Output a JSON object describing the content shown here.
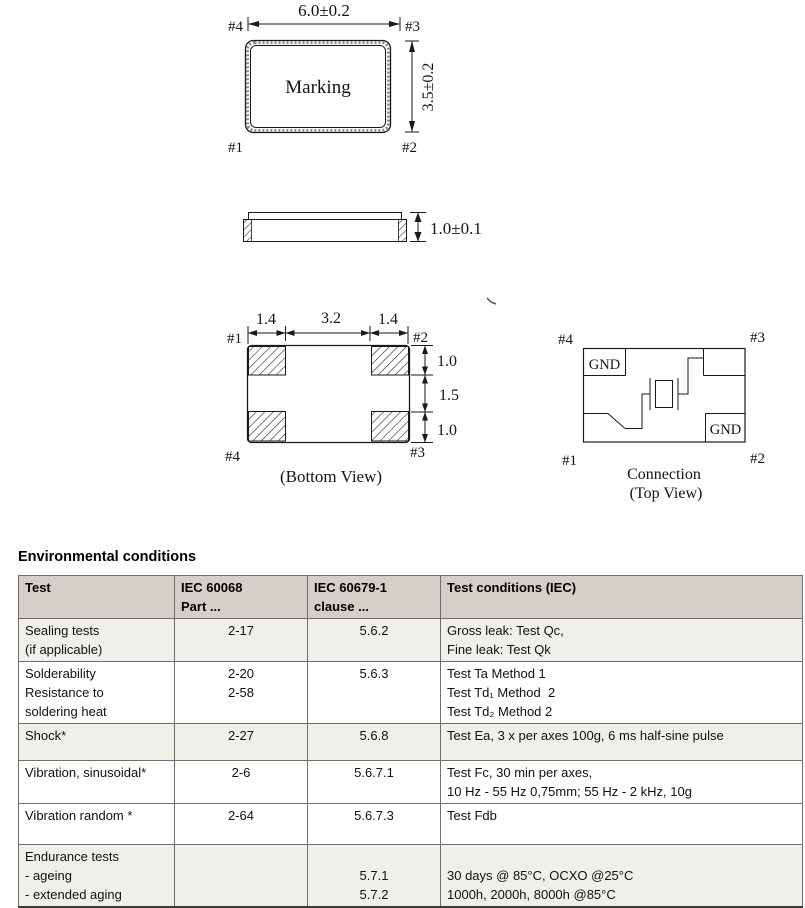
{
  "drawings": {
    "top_view": {
      "width_dim": "6.0±0.2",
      "height_dim": "3.5±0.2",
      "marking_label": "Marking",
      "pin_top_left": "#4",
      "pin_top_right": "#3",
      "pin_bottom_left": "#1",
      "pin_bottom_right": "#2"
    },
    "side_view": {
      "height_dim": "1.0±0.1"
    },
    "bottom_view": {
      "caption": "(Bottom View)",
      "dim_left": "1.4",
      "dim_center": "3.2",
      "dim_right": "1.4",
      "dim_top": "1.0",
      "dim_middle": "1.5",
      "dim_bottom": "1.0",
      "pin_top_left": "#1",
      "pin_top_right": "#2",
      "pin_bottom_left": "#4",
      "pin_bottom_right": "#3"
    },
    "connection_view": {
      "caption_line1": "Connection",
      "caption_line2": "(Top View)",
      "gnd_top_left": "GND",
      "gnd_bottom_right": "GND",
      "pin_top_left": "#4",
      "pin_top_right": "#3",
      "pin_bottom_left": "#1",
      "pin_bottom_right": "#2"
    }
  },
  "table": {
    "title": "Environmental conditions",
    "columns": [
      [
        "Test"
      ],
      [
        "IEC 60068",
        "Part ..."
      ],
      [
        "IEC 60679-1",
        "clause ..."
      ],
      [
        "Test conditions (IEC)"
      ]
    ],
    "rows": [
      {
        "test": [
          "Sealing tests",
          "(if applicable)"
        ],
        "part": [
          "2-17"
        ],
        "clause": [
          "5.6.2"
        ],
        "conditions": [
          "Gross leak: Test Qc,",
          "Fine leak: Test Qk"
        ]
      },
      {
        "test": [
          "Solderability",
          "Resistance to",
          "soldering heat"
        ],
        "part": [
          "2-20",
          "2-58"
        ],
        "clause": [
          "5.6.3"
        ],
        "conditions": [
          "Test Ta Method 1",
          "Test Td₁ Method  2",
          "Test Td₂ Method 2"
        ]
      },
      {
        "test": [
          "Shock*"
        ],
        "part": [
          "2-27"
        ],
        "clause": [
          "5.6.8"
        ],
        "conditions": [
          "Test Ea, 3 x per axes 100g, 6 ms half-sine pulse"
        ]
      },
      {
        "test": [
          "Vibration, sinusoidal*"
        ],
        "part": [
          "2-6"
        ],
        "clause": [
          "5.6.7.1"
        ],
        "conditions": [
          "Test Fc, 30 min per axes,",
          "10 Hz - 55 Hz 0,75mm; 55 Hz - 2 kHz, 10g"
        ]
      },
      {
        "test": [
          "Vibration random *"
        ],
        "part": [
          "2-64"
        ],
        "clause": [
          "5.6.7.3"
        ],
        "conditions": [
          "Test Fdb"
        ]
      },
      {
        "test": [
          "Endurance tests",
          "- ageing",
          "- extended aging"
        ],
        "part": [],
        "clause": [
          "",
          "5.7.1",
          "5.7.2"
        ],
        "conditions": [
          "",
          "30 days @ 85°C, OCXO @25°C",
          "1000h, 2000h, 8000h @85°C"
        ]
      }
    ],
    "colors": {
      "header_bg": "#d3d0c9",
      "alt_row_bg": "#f1efe9",
      "row_bg": "#ffffff",
      "grid": "#6e6e6e",
      "text": "#111111"
    }
  }
}
